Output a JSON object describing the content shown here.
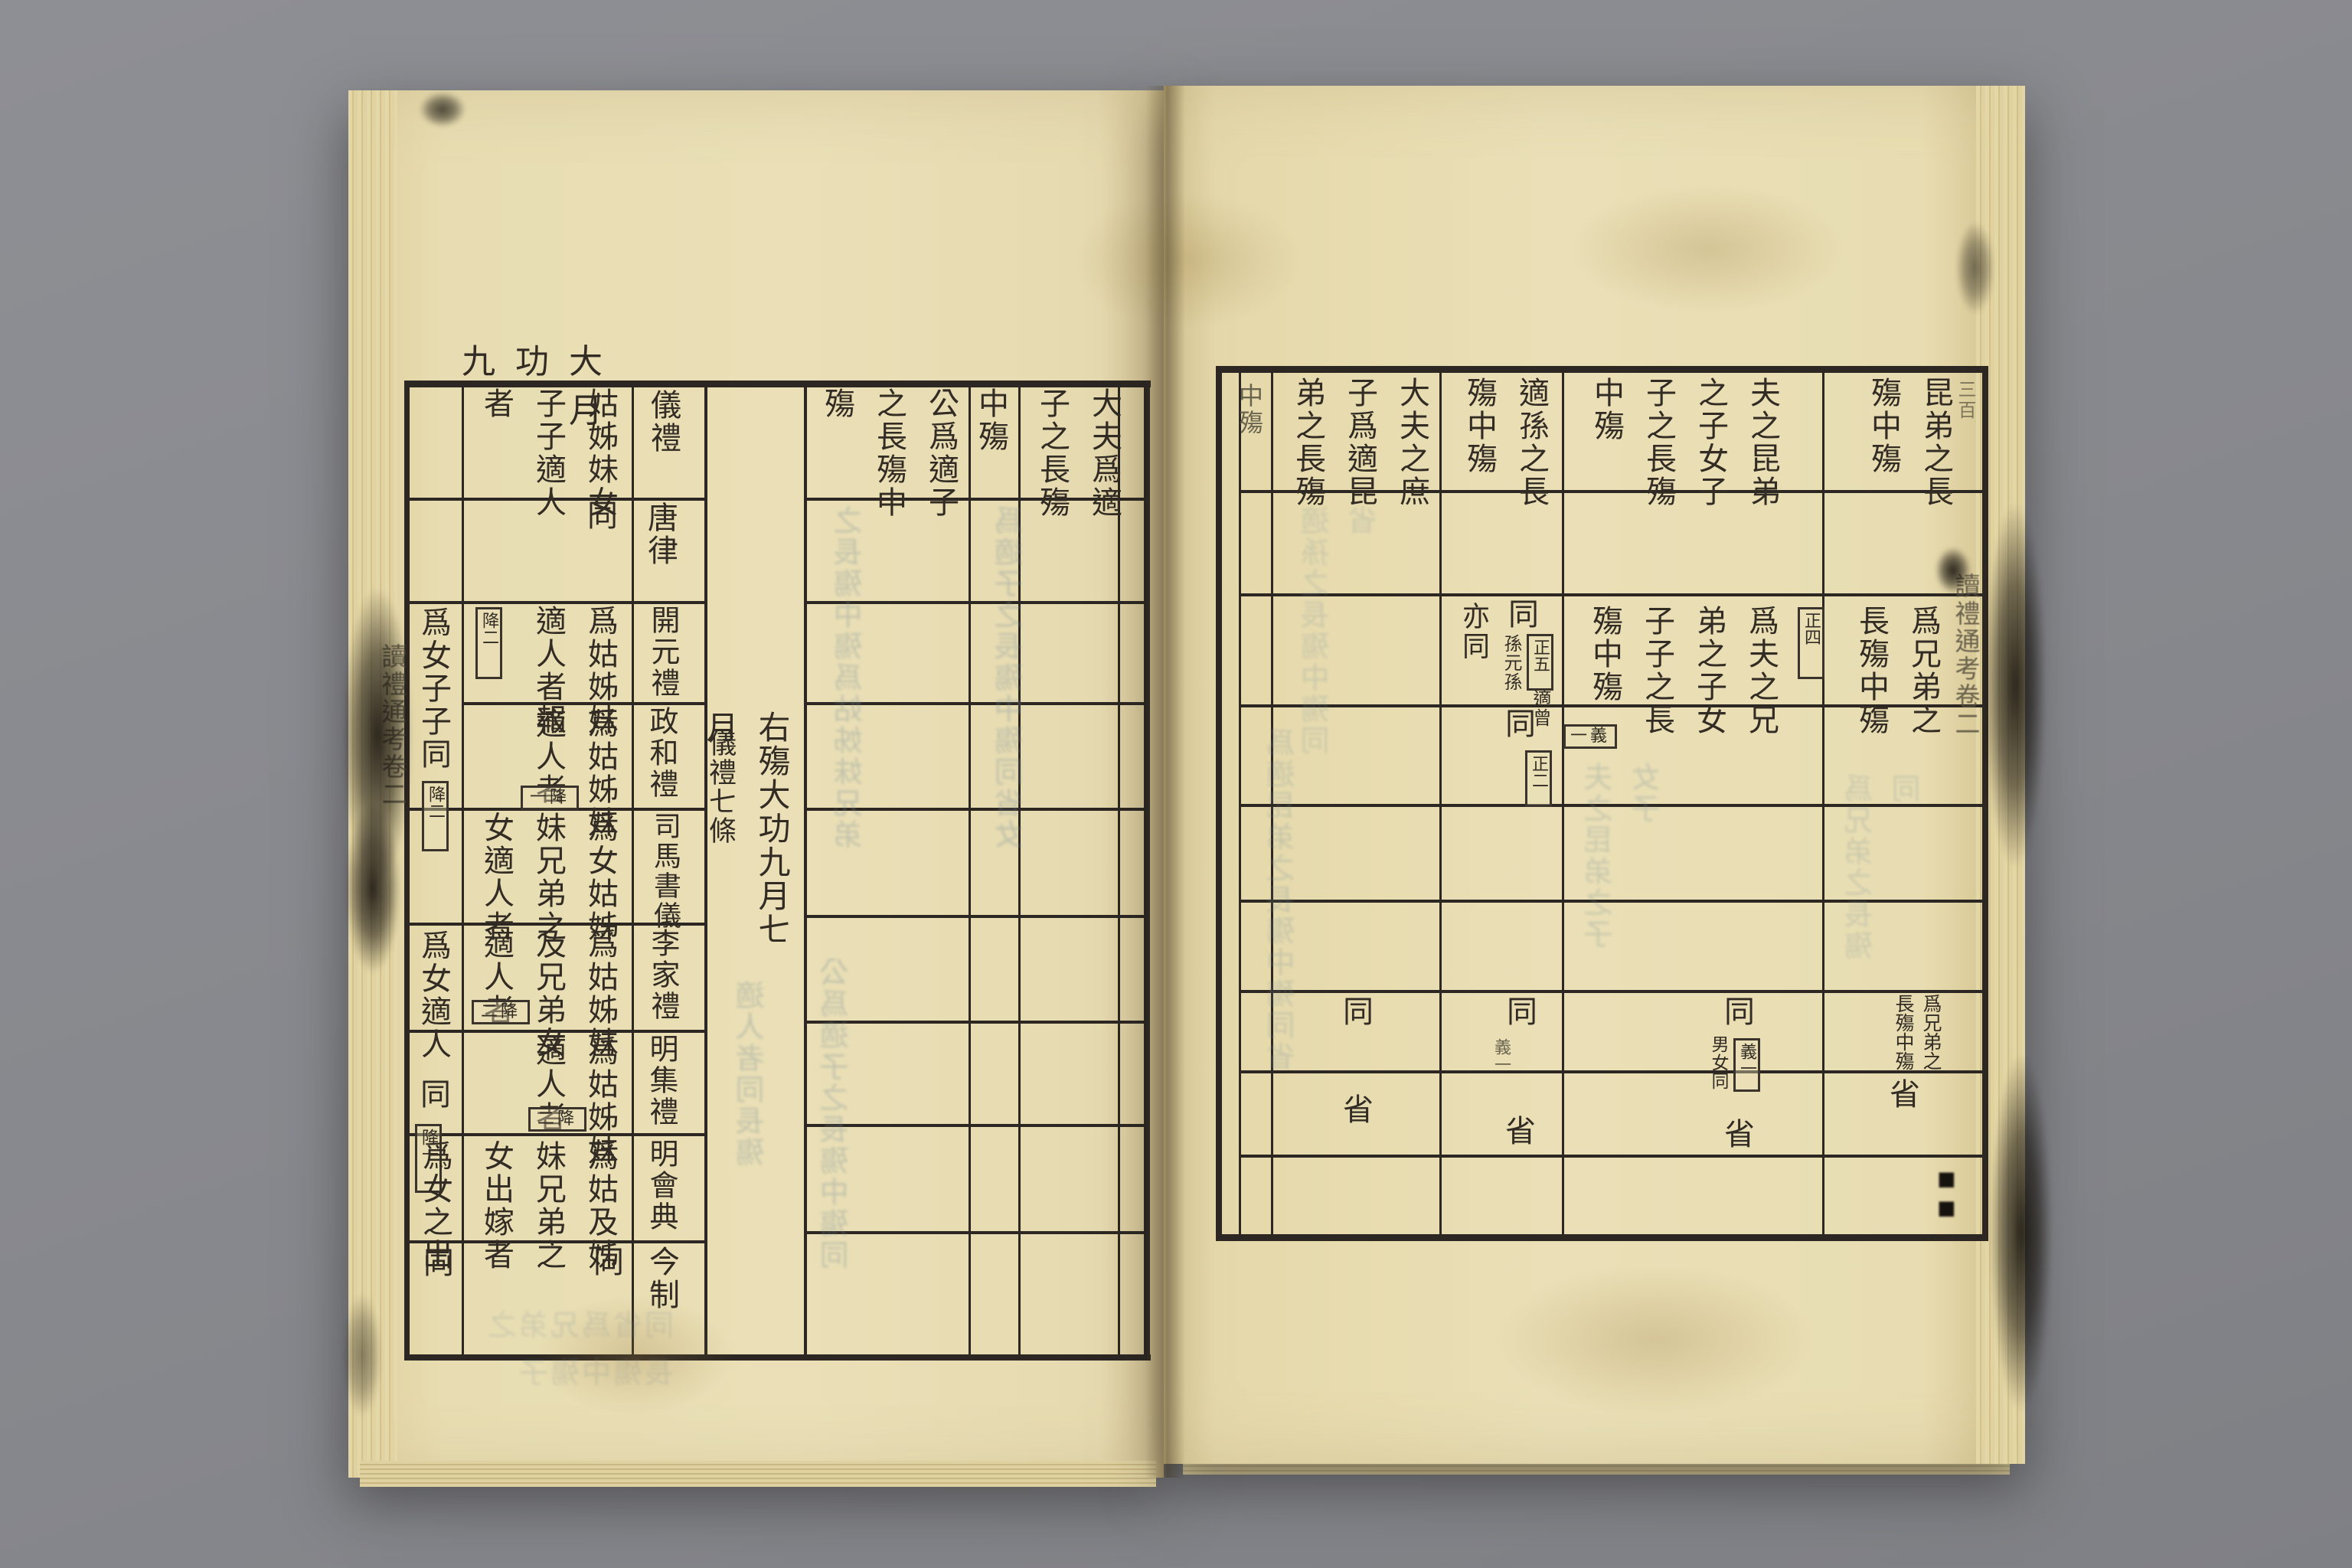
{
  "colors": {
    "background_gray": "#8a8b90",
    "paper_cream": "#e8ddb2",
    "table_ink": "#2c2722",
    "text_ink": "#322c24",
    "bleedthrough_blue": "#7d929b"
  },
  "left": {
    "margin_title": "大功九月",
    "edge_title": "讀禮通考卷二",
    "headers": {
      "col1": "大夫爲適子之長殤",
      "col2": "中殤",
      "col3": "公爲適子之長殤中殤",
      "case1": "姑姊妹女子子適人者"
    },
    "summary": {
      "main": "右殤大功九月七月",
      "sub": "儀禮七條"
    },
    "labels": {
      "r1": "儀禮",
      "r2": "唐律",
      "r3": "開元禮",
      "r4": "政和禮",
      "r5": "司馬書儀",
      "r6": "李家禮",
      "r7": "明集禮",
      "r8": "明會典",
      "r9": "今制"
    },
    "case1": {
      "r2": "同",
      "r3": "爲姑姊妹適人者報",
      "r3_note": "降二",
      "r4": "爲姑姊妹適人者",
      "r4_note": "降一",
      "r5": "爲女姑姊妹兄弟之女適人者",
      "r6": "爲姑姊妹及兄弟女適人者",
      "r6_note": "降二",
      "r7": "爲姑姊妹適人者",
      "r7_note": "降二",
      "r8": "爲姑及姊妹兄弟之女出嫁者",
      "r9": "同"
    },
    "case2": {
      "r34": "爲女子子同",
      "r34_note": "降二",
      "r6": "爲女適人",
      "r7": "同",
      "r7_note": "降一",
      "r8": "爲女之出",
      "r9": "同"
    }
  },
  "right": {
    "headers": {
      "a": "昆弟之長殤中殤",
      "b": "夫之昆弟之子女子子之長殤中殤",
      "c": "適孫之長殤中殤",
      "d": "大夫之庶子爲適昆弟之長殤",
      "e": "中殤"
    },
    "a": {
      "r3": "爲兄弟之長殤中殤",
      "r3_note": "正四",
      "r7": "爲兄弟之長殤中殤",
      "r8": "省"
    },
    "b": {
      "r3": "爲夫之兄弟之子女子子之長殤中殤",
      "r3_note": "義一",
      "r7": "同",
      "r7_box": "義一",
      "r7_small": "男女同",
      "r8": "省"
    },
    "c": {
      "r3_t1": "同",
      "r3_box1": "正五",
      "r3_s1": "適曾",
      "r3_s2": "孫元孫",
      "r3_t2": "同",
      "r3_box2": "正二",
      "r3_also": "亦同",
      "r7": "同",
      "r7_note": "義一",
      "r8": "省"
    },
    "d": {
      "r7": "同",
      "r8": "省"
    },
    "edge_title": "讀禮通考卷二",
    "edge_mark": "三百"
  },
  "ghost": {
    "g1": "之長殤中殤爲姑姊妹兄弟",
    "g2": "爲適子之長殤中殤同省女",
    "g3": "適人者同長殤",
    "g4": "同省爲兄弟之長殤中殤子",
    "g5": "夫之昆弟之子女子",
    "g6": "爲適昆弟之長殤中殤同省",
    "g7": "爲兄弟之長殤同",
    "g8": "公爲適子之長殤中殤同",
    "g9": "適孫之長殤中殤同省"
  }
}
